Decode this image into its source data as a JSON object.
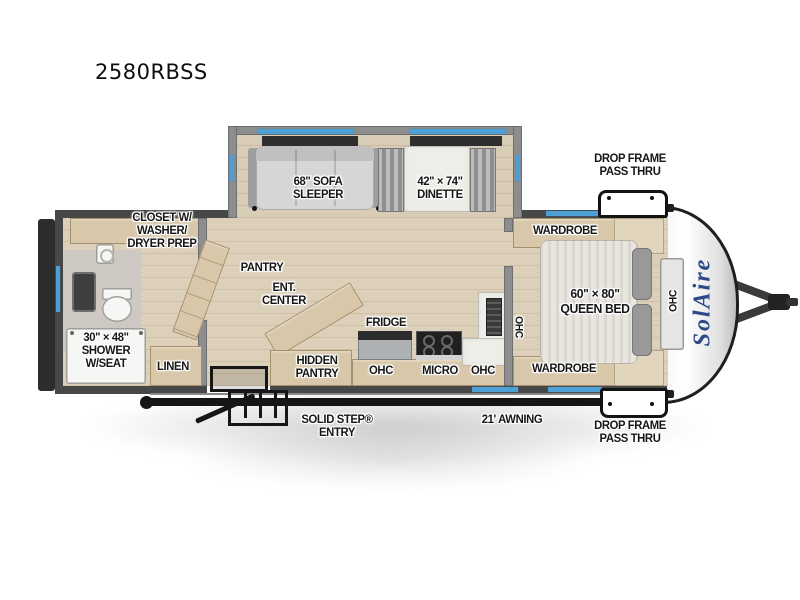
{
  "page": {
    "title": "2580RBSS"
  },
  "colors": {
    "accent_blue": "#4d9fd6",
    "wall": "#474747",
    "wood": "#d8c7a9",
    "label": "#161616",
    "logo_blue": "#2c4a8a"
  },
  "labels": {
    "sofa": [
      "68\" SOFA",
      "SLEEPER"
    ],
    "dinette": [
      "42\" × 74\"",
      "DINETTE"
    ],
    "pass_thru_top": [
      "DROP FRAME",
      "PASS THRU"
    ],
    "pass_thru_bottom": [
      "DROP FRAME",
      "PASS THRU"
    ],
    "closet": [
      "CLOSET W/",
      "WASHER/",
      "DRYER PREP"
    ],
    "pantry": "PANTRY",
    "ent_center": [
      "ENT.",
      "CENTER"
    ],
    "hidden_pantry": [
      "HIDDEN",
      "PANTRY"
    ],
    "fridge": "FRIDGE",
    "ohc_fridge": "OHC",
    "micro": "MICRO",
    "ohc_micro": "OHC",
    "ohc_kitchen_wall": "OHC",
    "wardrobe_top": "WARDROBE",
    "wardrobe_bottom": "WARDROBE",
    "queen_bed": [
      "60\" × 80\"",
      "QUEEN BED"
    ],
    "ohc_front": "OHC",
    "shower": [
      "30\" × 48\"",
      "SHOWER",
      "W/SEAT"
    ],
    "linen": "LINEN",
    "entry": [
      "SOLID STEP®",
      "ENTRY"
    ],
    "awning": "21' AWNING",
    "logo": "SolAire"
  }
}
